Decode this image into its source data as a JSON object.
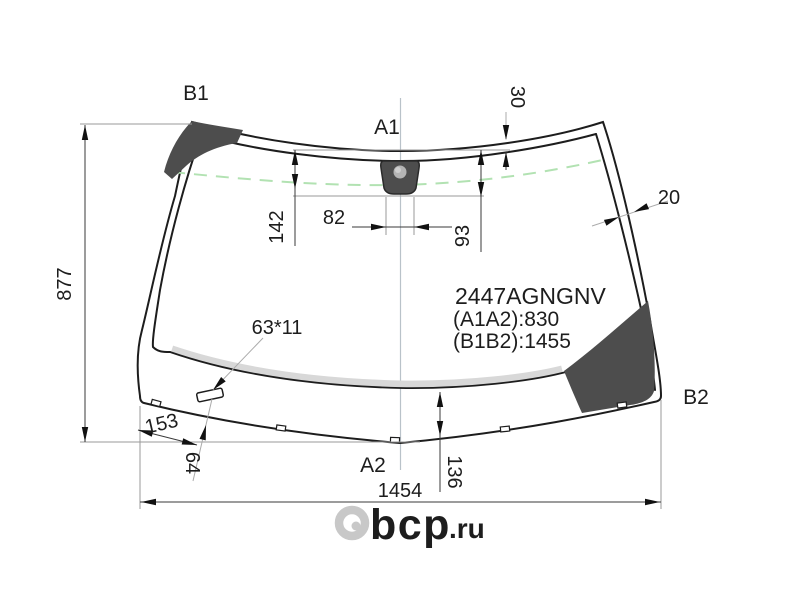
{
  "labels": {
    "b1": "B1",
    "a1": "A1",
    "a2": "A2",
    "b2": "B2"
  },
  "dims": {
    "height": "877",
    "shade_depth": "142",
    "sensor_width": "82",
    "right_offset": "93",
    "top_offset": "30",
    "edge_width": "20",
    "slot_size": "63*11",
    "left_offset": "153",
    "slot_dist": "64",
    "bottom_offset": "136",
    "width": "1454"
  },
  "part": {
    "number": "2447AGNGNV",
    "a1a2": "(A1A2):830",
    "b1b2": "(B1B2):1455"
  },
  "watermark": {
    "main": "bcp",
    "suffix": ".ru"
  },
  "colors": {
    "line": "#1d1d1d",
    "dark_area": "#4d4d4d",
    "green_dash": "#b2e2b2",
    "bottom_band": "#d8d8d8",
    "centerline": "#b9c2c9",
    "watermark": "#c8c8c8",
    "watermark_suffix": "#cfcfcf"
  }
}
